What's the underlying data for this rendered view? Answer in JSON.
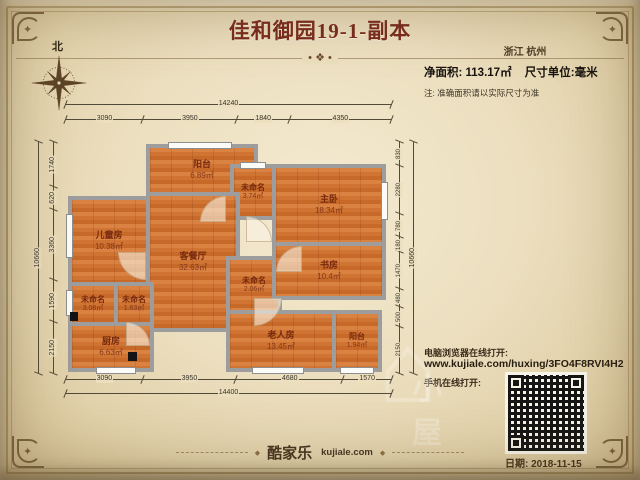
{
  "meta": {
    "title": "佳和御园19-1-副本",
    "region": "浙江 杭州",
    "net_area": "净面积: 113.17㎡",
    "unit": "尺寸单位:毫米",
    "note": "注: 准确面积请以实际尺寸为准",
    "north": "北"
  },
  "plan": {
    "rooms": [
      {
        "id": "balcony-top",
        "name": "阳台",
        "area": "6.89㎡",
        "x": 146,
        "y": 144,
        "w": 112,
        "h": 52
      },
      {
        "id": "unnamed-hall",
        "name": "未命名",
        "area": "3.74㎡",
        "x": 230,
        "y": 164,
        "w": 46,
        "h": 56,
        "small": true
      },
      {
        "id": "master-bedroom",
        "name": "主卧",
        "area": "18.34㎡",
        "x": 272,
        "y": 164,
        "w": 114,
        "h": 82
      },
      {
        "id": "children-room",
        "name": "儿童房",
        "area": "10.38㎡",
        "x": 68,
        "y": 196,
        "w": 82,
        "h": 90
      },
      {
        "id": "living-dining",
        "name": "客餐厅",
        "area": "32.63㎡",
        "x": 146,
        "y": 192,
        "w": 94,
        "h": 140
      },
      {
        "id": "unnamed-left-a",
        "name": "未命名",
        "area": "3.08㎡",
        "x": 68,
        "y": 282,
        "w": 50,
        "h": 44,
        "small": true
      },
      {
        "id": "unnamed-left-b",
        "name": "未命名",
        "area": "1.63㎡",
        "x": 114,
        "y": 282,
        "w": 40,
        "h": 44,
        "small": true
      },
      {
        "id": "kitchen",
        "name": "厨房",
        "area": "6.63㎡",
        "x": 68,
        "y": 322,
        "w": 86,
        "h": 50
      },
      {
        "id": "unnamed-mid",
        "name": "未命名",
        "area": "2.06㎡",
        "x": 226,
        "y": 256,
        "w": 56,
        "h": 58,
        "small": true
      },
      {
        "id": "study",
        "name": "书房",
        "area": "10.4㎡",
        "x": 272,
        "y": 242,
        "w": 114,
        "h": 58
      },
      {
        "id": "elder-room",
        "name": "老人房",
        "area": "13.45㎡",
        "x": 226,
        "y": 310,
        "w": 110,
        "h": 62
      },
      {
        "id": "balcony-bottom",
        "name": "阳台",
        "area": "1.94㎡",
        "x": 332,
        "y": 310,
        "w": 50,
        "h": 62,
        "small": true
      }
    ],
    "windows": [
      {
        "x": 168,
        "y": 142,
        "w": 64,
        "h": 7
      },
      {
        "x": 240,
        "y": 162,
        "w": 26,
        "h": 7
      },
      {
        "x": 66,
        "y": 214,
        "w": 7,
        "h": 44
      },
      {
        "x": 66,
        "y": 290,
        "w": 7,
        "h": 26
      },
      {
        "x": 96,
        "y": 367,
        "w": 40,
        "h": 7
      },
      {
        "x": 381,
        "y": 182,
        "w": 7,
        "h": 38
      },
      {
        "x": 252,
        "y": 367,
        "w": 52,
        "h": 7
      },
      {
        "x": 340,
        "y": 367,
        "w": 34,
        "h": 7
      }
    ],
    "doors": [
      {
        "x": 118,
        "y": 252,
        "s": 28,
        "corner": "sw"
      },
      {
        "x": 246,
        "y": 216,
        "s": 26,
        "corner": "ne"
      },
      {
        "x": 200,
        "y": 196,
        "s": 26,
        "corner": "nw"
      },
      {
        "x": 276,
        "y": 246,
        "s": 26,
        "corner": "nw"
      },
      {
        "x": 254,
        "y": 298,
        "s": 28,
        "corner": "se"
      },
      {
        "x": 126,
        "y": 322,
        "s": 24,
        "corner": "ne"
      }
    ],
    "columns": [
      {
        "x": 70,
        "y": 312,
        "w": 8,
        "h": 9
      },
      {
        "x": 128,
        "y": 352,
        "w": 9,
        "h": 9
      }
    ],
    "dims": {
      "top_total": 14240,
      "top": [
        3090,
        3950,
        1840,
        4350
      ],
      "bottom": [
        3090,
        3950,
        4680,
        1570
      ],
      "bottom_total": 14400,
      "left_total": 10660,
      "left": [
        1740,
        620,
        3360,
        1590,
        2150
      ],
      "right": [
        830,
        2280,
        780,
        180,
        1470,
        480,
        500,
        2150
      ],
      "right_total": 10660
    }
  },
  "share": {
    "pc_label": "电脑浏览器在线打开:",
    "url": "www.kujiale.com/huxing/3FO4F8RVI4H2",
    "mobile_label": "手机在线打开:"
  },
  "footer": {
    "brand": "酷家乐",
    "brand_domain": "kujiale.com",
    "date": "日期: 2018-11-15"
  },
  "icons": {
    "divider_ornament": "• ❖ •",
    "footer_diamond": "◆",
    "corner_star": "✦",
    "watermark_house": "⌂",
    "watermark_text": "小屋"
  },
  "colors": {
    "parchment": "#ecdfbf",
    "title": "#7a2a1c",
    "wall": "#9d9d9d",
    "floor": "#d07433",
    "room_label": "#76290d",
    "dim_line": "#514a38"
  }
}
